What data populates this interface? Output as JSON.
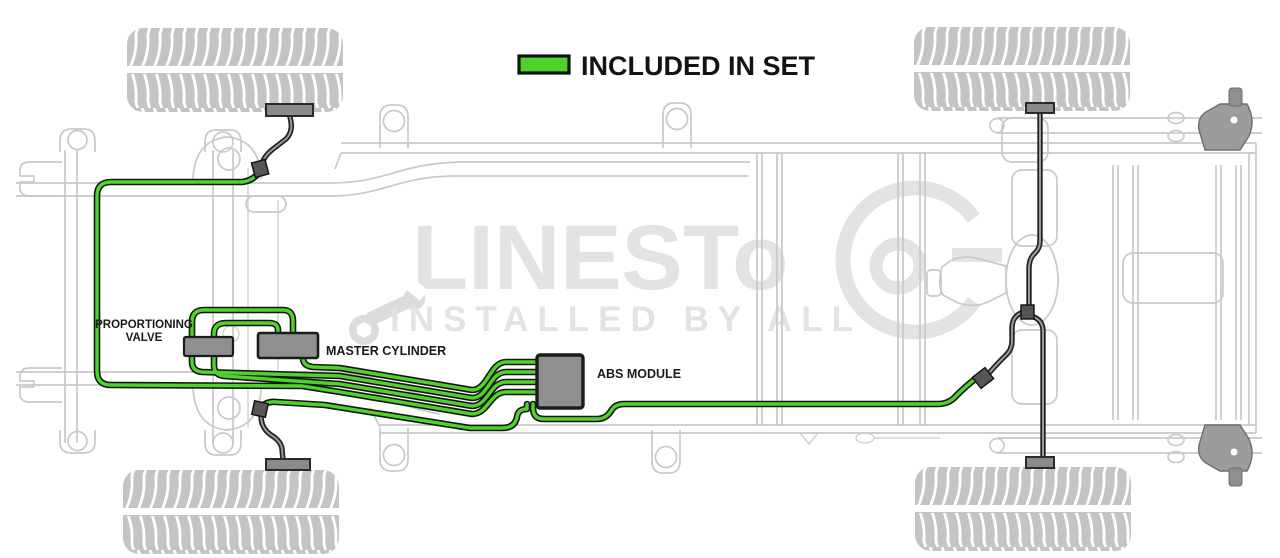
{
  "legend": {
    "label": "INCLUDED IN SET"
  },
  "labels": {
    "proportioning_valve_line1": "PROPORTIONING",
    "proportioning_valve_line2": "VALVE",
    "master_cylinder": "MASTER CYLINDER",
    "abs_module": "ABS MODULE"
  },
  "watermark": {
    "brand_text": "LINESTo",
    "tagline": "INSTALLED BY ALL"
  },
  "colors": {
    "included_line_green": "#4fd32b",
    "line_outline_black": "#151515",
    "hose_core_gray": "#9a9a9a",
    "component_gray": "#8f8f8f",
    "frame_gray": "#c9c9c9",
    "tire_gray": "#c4c4c4",
    "watermark_gray": "#e3e3e3"
  }
}
